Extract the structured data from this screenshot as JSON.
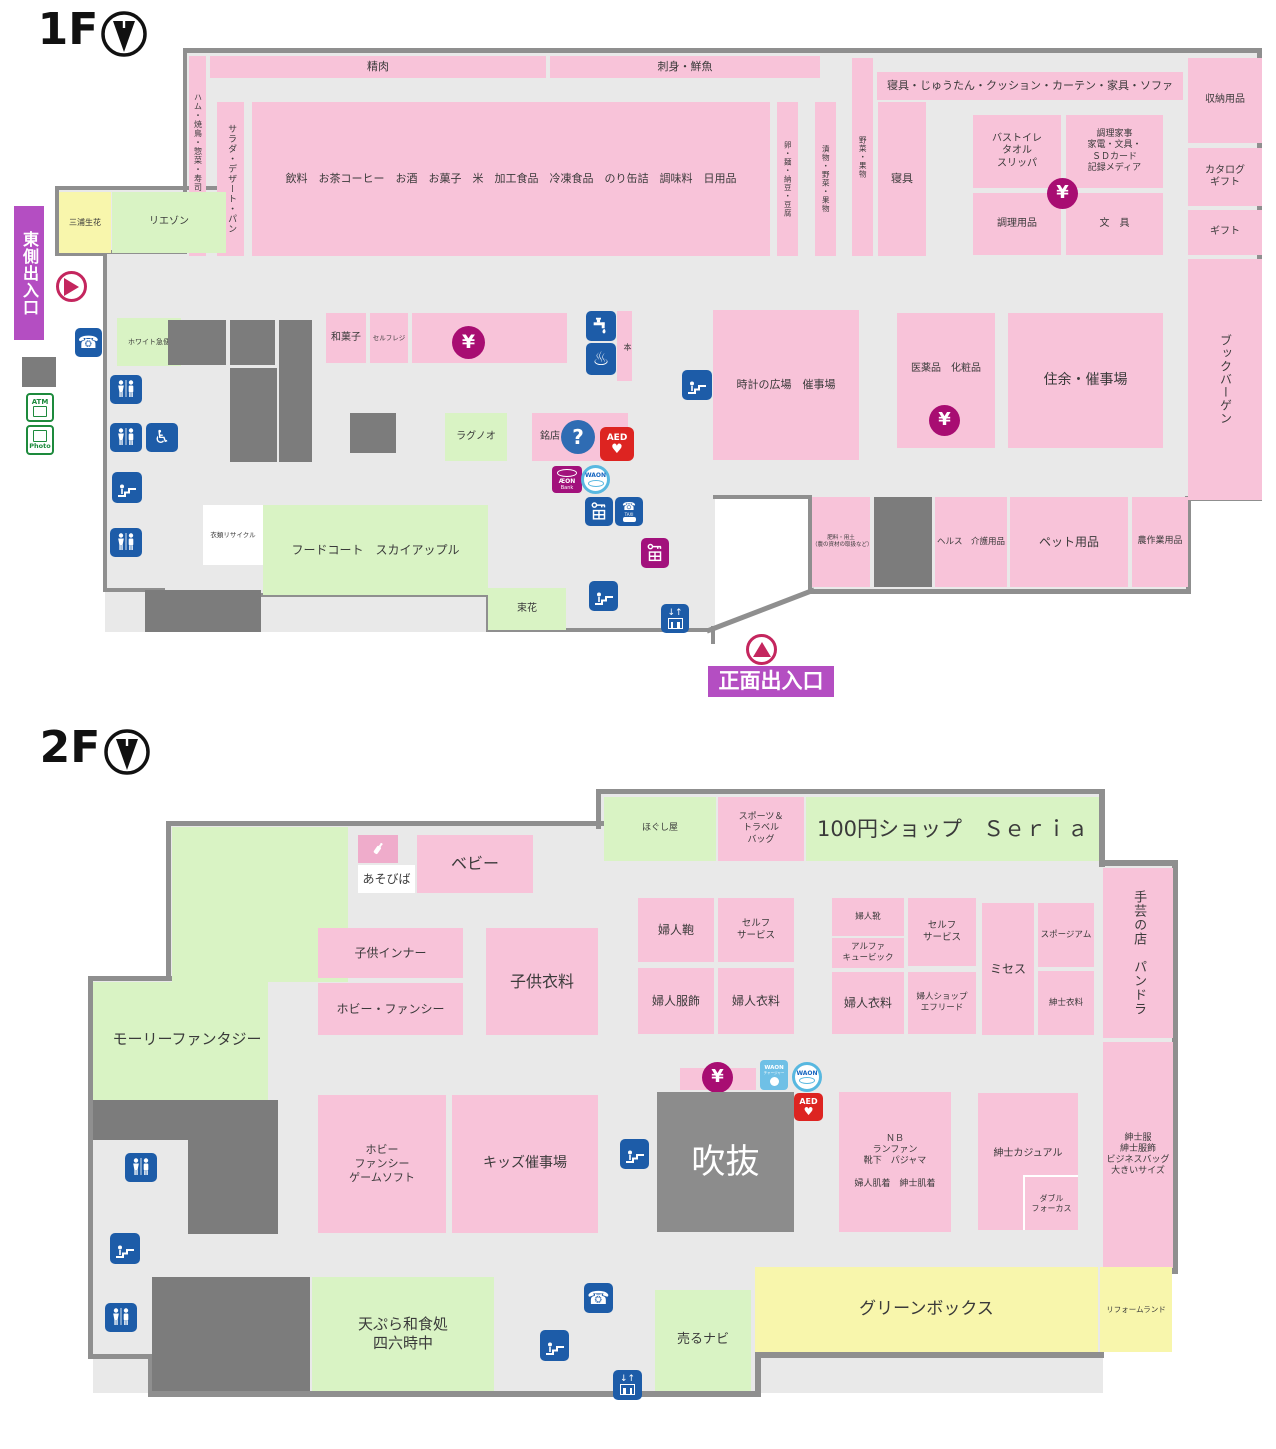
{
  "header": {
    "f1": "1F",
    "f2": "2F"
  },
  "icons": {
    "yen": "¥",
    "question": "?",
    "aed": "AED",
    "atm": "ATM",
    "photo": "Photo",
    "phone": "☎",
    "onsen": "♨",
    "wheelchair": "♿",
    "elevator_arrows": "↓↑",
    "waon": "WAON",
    "charger": "WAON",
    "charger_sub": "チャージャー",
    "aeon": "ÆON",
    "aeon_sub": "Bank",
    "taxi": "TAXI"
  },
  "f1": {
    "east_entrance": "東側出入口",
    "main_entrance": "正面出入口",
    "miura": "三浦生花",
    "liaison": "リエゾン",
    "ham": "ハム・焼鳥・惣菜・寿司・弁当",
    "seiniku": "精肉",
    "sashimi": "刺身・鮮魚",
    "salad": "サラダ・デザート・パン",
    "grocery": "飲料　お茶コーヒー　お酒　お菓子　米　加工食品　冷凍食品　のり缶詰　調味料　日用品",
    "egg": "卵・麺・納豆・豆腐",
    "tsukemono": "漬物・野菜・果物",
    "yasai": "野菜・果物",
    "shingu_strip": "寝具・じゅうたん・クッション・カーテン・家具・ソファ",
    "shingu": "寝具",
    "bath": "バストイレ\nタオル\nスリッパ",
    "kaji": "調理家事\n家電・文具・\nＳＤカード\n記録メディア",
    "chori": "調理用品",
    "bungu": "文　具",
    "shuno": "収納用品",
    "catalog": "カタログ\nギフト",
    "gift": "ギフト",
    "books": "ブックバーゲン",
    "white": "ホワイト急便",
    "wagashi": "和菓子",
    "selfregi": "セルフレジ",
    "hon": "本",
    "tokei": "時計の広場　催事場",
    "ragnoo": "ラグノオ",
    "meiten": "銘店",
    "recycle": "衣類リサイクル",
    "foodcourt": "フードコート　スカイアップル",
    "tabane": "束花",
    "iyaku": "医薬品　化粧品",
    "jusai": "住余・催事場",
    "hiryo": "肥料・用土\n（農の資材の取扱など）",
    "health": "ヘルス　介護用品",
    "pet": "ペット用品",
    "nosagyo": "農作業用品"
  },
  "f2": {
    "hogushiya": "ほぐし屋",
    "sports": "スポーツ＆\nトラベル\nバッグ",
    "seria": "100円ショップ　Ｓｅｒｉａ",
    "shugei": "手芸の店　パンドラ",
    "asobiba": "あそびば",
    "baby": "ベビー",
    "inner": "子供インナー",
    "hobby": "ホビー・ファンシー",
    "kodomo": "子供衣料",
    "molly": "モーリーファンタジー",
    "kaban": "婦人鞄",
    "self1": "セルフ\nサービス",
    "fukushoku": "婦人服飾",
    "iryo1": "婦人衣料",
    "kutsu": "婦人靴",
    "alpha": "アルファ\nキュービック",
    "self2": "セルフ\nサービス",
    "iryo2": "婦人衣料",
    "efleed": "婦人ショップ\nエフリード",
    "mrs": "ミセス",
    "sporium": "スポージアム",
    "shinshi_iryo": "紳士衣料",
    "hobbygame": "ホビー\nファンシー\nゲームソフト",
    "kids": "キッズ催事場",
    "fukinuke": "吹抜",
    "nb": "ＮＢ\nランファン\n靴下　パジャマ\n\n婦人肌着　紳士肌着",
    "casual": "紳士カジュアル",
    "wfocus": "ダブル\nフォーカス",
    "shinshifuku": "紳士服\n紳士服飾\nビジネスバッグ\n大きいサイズ",
    "tempura": "天ぷら和食処\n四六時中",
    "urunavi": "売るナビ",
    "greenbox": "グリーンボックス",
    "reform": "リフォームランド"
  }
}
